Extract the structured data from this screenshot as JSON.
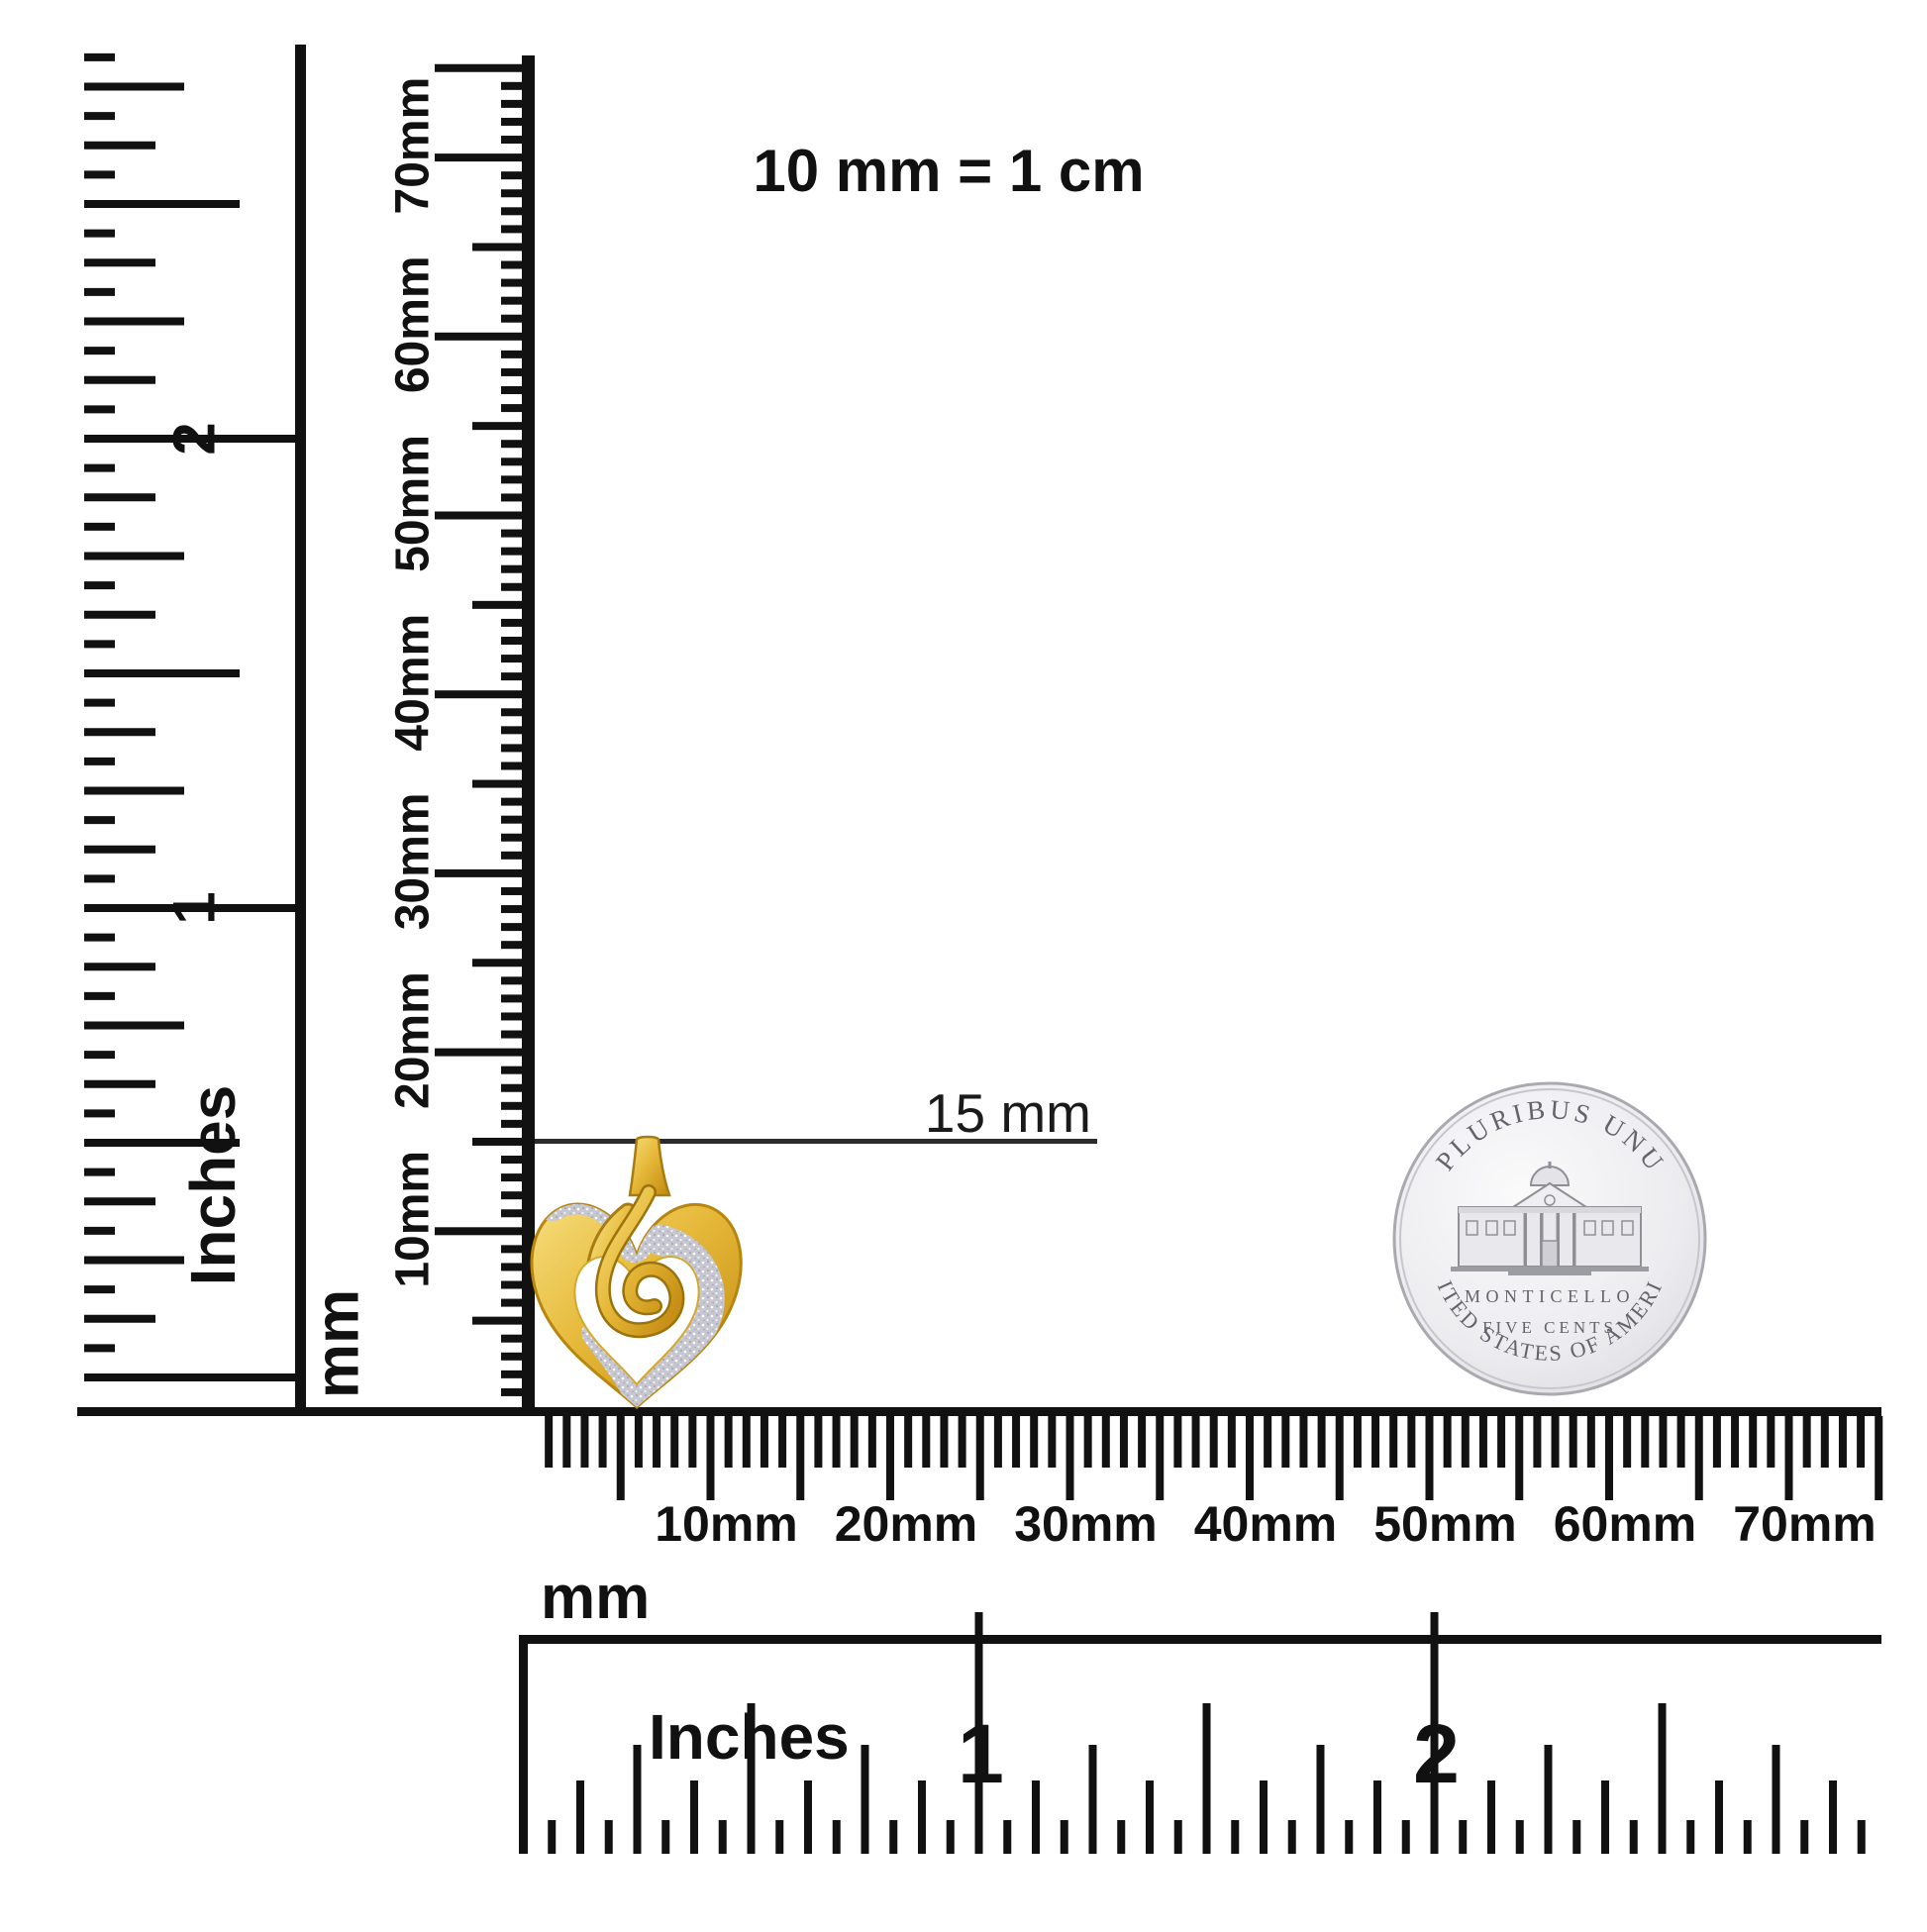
{
  "title_note": {
    "text": "10 mm = 1 cm"
  },
  "measurement_callout": {
    "label": "15 mm"
  },
  "rulers": {
    "left_inch": {
      "unit": "Inches",
      "numerals": [
        "1",
        "2"
      ]
    },
    "vertical_mm": {
      "unit": "mm",
      "labels": [
        "10mm",
        "20mm",
        "30mm",
        "40mm",
        "50mm",
        "60mm",
        "70mm"
      ]
    },
    "bottom_mm": {
      "unit": "mm",
      "labels": [
        "10mm",
        "20mm",
        "30mm",
        "40mm",
        "50mm",
        "60mm",
        "70mm"
      ]
    },
    "bottom_inch": {
      "unit": "Inches",
      "numerals": [
        "1",
        "2"
      ]
    }
  },
  "coin": {
    "top_legend": "E PLURIBUS UNUM",
    "building": "MONTICELLO",
    "denomination": "FIVE CENTS",
    "bottom_legend": "UNITED STATES OF AMERICA"
  },
  "colors": {
    "ink": "#111111",
    "callout_line": "#2b2b2b",
    "gold": "#d9a521",
    "gold_dark": "#a87c10",
    "gold_light": "#f3d675",
    "glitter": "#c7c7d1",
    "coin_silver": "#e8e8ec",
    "coin_text": "#63636b"
  }
}
